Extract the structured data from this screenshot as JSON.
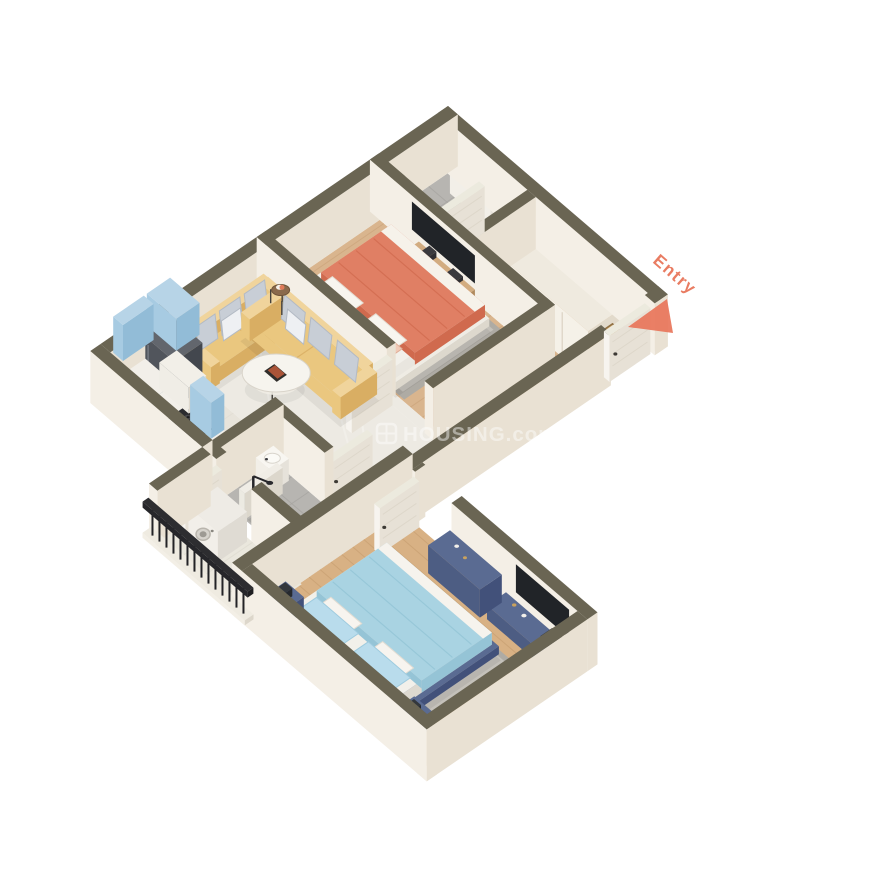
{
  "labels": {
    "entry": "Entry",
    "watermark": "HOUSING.com"
  },
  "colors": {
    "bg": "#ffffff",
    "entry_accent": "#e8755a",
    "watermark": "#ffffff",
    "wall_top": "#6a6553",
    "wall_e": "#e9e1d3",
    "wall_s": "#f4efe6",
    "wood1": "#d9b58e",
    "wood1_line": "#c69d73",
    "wood2": "#d8b184",
    "wood2_line": "#c1986a",
    "marble": "#edeae3",
    "marble_line": "#f8f6f1",
    "kitchen_floor": "#e8e4db",
    "tile": "#b7b5b1",
    "tile_line": "#a5a39f",
    "balcony_floor": "#eae7dd",
    "rug": "#aeaba4",
    "rug_inner": "#c4c1ba",
    "bed1": "#e07f64",
    "bed1_dark": "#d06a4e",
    "bed1_fold": "#cb6246",
    "bed1_pillow": "#f0c9b6",
    "bed2": "#a9d3e2",
    "bed2_dark": "#95c4d6",
    "bed2_fold": "#8cc0d2",
    "bed2_pillow": "#b9dcec",
    "navy": "#4d5d83",
    "navy_top": "#5a6b92",
    "navy_dark": "#42517a",
    "sofa": "#eac77f",
    "sofa_top": "#f0d49c",
    "sofa_dark": "#d9ae63",
    "pillow": "#c8ced6",
    "pillow_line": "#b3bac4",
    "pillow_white": "#eef0f3",
    "wood_console": "#c9a173",
    "tv": "#212428",
    "door_face": "#f7f4ef",
    "door_side": "#e7e1d6",
    "door_top": "#eceade",
    "door_panel": "#ddd6c9",
    "handle": "#3d3a35",
    "mat": "#c59c62",
    "mat_border": "#8f6f42",
    "blue_cab": "#a7cbe2",
    "blue_cab_dark": "#92bcd7",
    "blue_cab_top": "#b7d4e7",
    "counter": "#f2efe9",
    "fridge": "#43474e",
    "fridge_top": "#62666d",
    "fridge_side": "#51555c",
    "hood": "#f0ede6",
    "steel": "#2b2b2f",
    "white_fix": "#f8f6f1",
    "fix_stroke": "#d9d5cd",
    "partition": "#f0ede6",
    "brown_shelf": "#6b4832",
    "drain": "#a8a6a1",
    "rail": "#232326",
    "shadow": "rgba(0,0,0,0.06)"
  },
  "scene": {
    "type": "isometric-3d-floor-plan",
    "rooms": [
      {
        "name": "toilet-1",
        "items": [
          "vanity",
          "mirror",
          "toilet"
        ]
      },
      {
        "name": "wardrobe-niche",
        "items": [
          "wardrobe"
        ]
      },
      {
        "name": "master-bedroom",
        "items": [
          "area-rug",
          "double-bed-orange",
          "tv-panel",
          "media-console",
          "toilet-door"
        ]
      },
      {
        "name": "entry-foyer",
        "items": [
          "entry-door",
          "doormat"
        ]
      },
      {
        "name": "living-room",
        "items": [
          "sofa-two-seater",
          "sofa-three-seater",
          "coffee-table",
          "side-table",
          "bedroom-door",
          "bathroom-door"
        ]
      },
      {
        "name": "kitchen",
        "items": [
          "refrigerator",
          "l-counter",
          "gas-hob",
          "chimney-hood",
          "upper-cabinets",
          "open-shelf"
        ]
      },
      {
        "name": "bathroom",
        "items": [
          "washbasin",
          "toilet",
          "shower",
          "glass-partition",
          "drain-area",
          "balcony-door"
        ]
      },
      {
        "name": "bedroom-2",
        "items": [
          "door",
          "dresser",
          "media-console",
          "tv-panel",
          "area-rug",
          "double-bed-blue",
          "nightstand-left",
          "nightstand-right"
        ]
      },
      {
        "name": "balcony",
        "items": [
          "washing-machine",
          "railing"
        ]
      }
    ]
  }
}
